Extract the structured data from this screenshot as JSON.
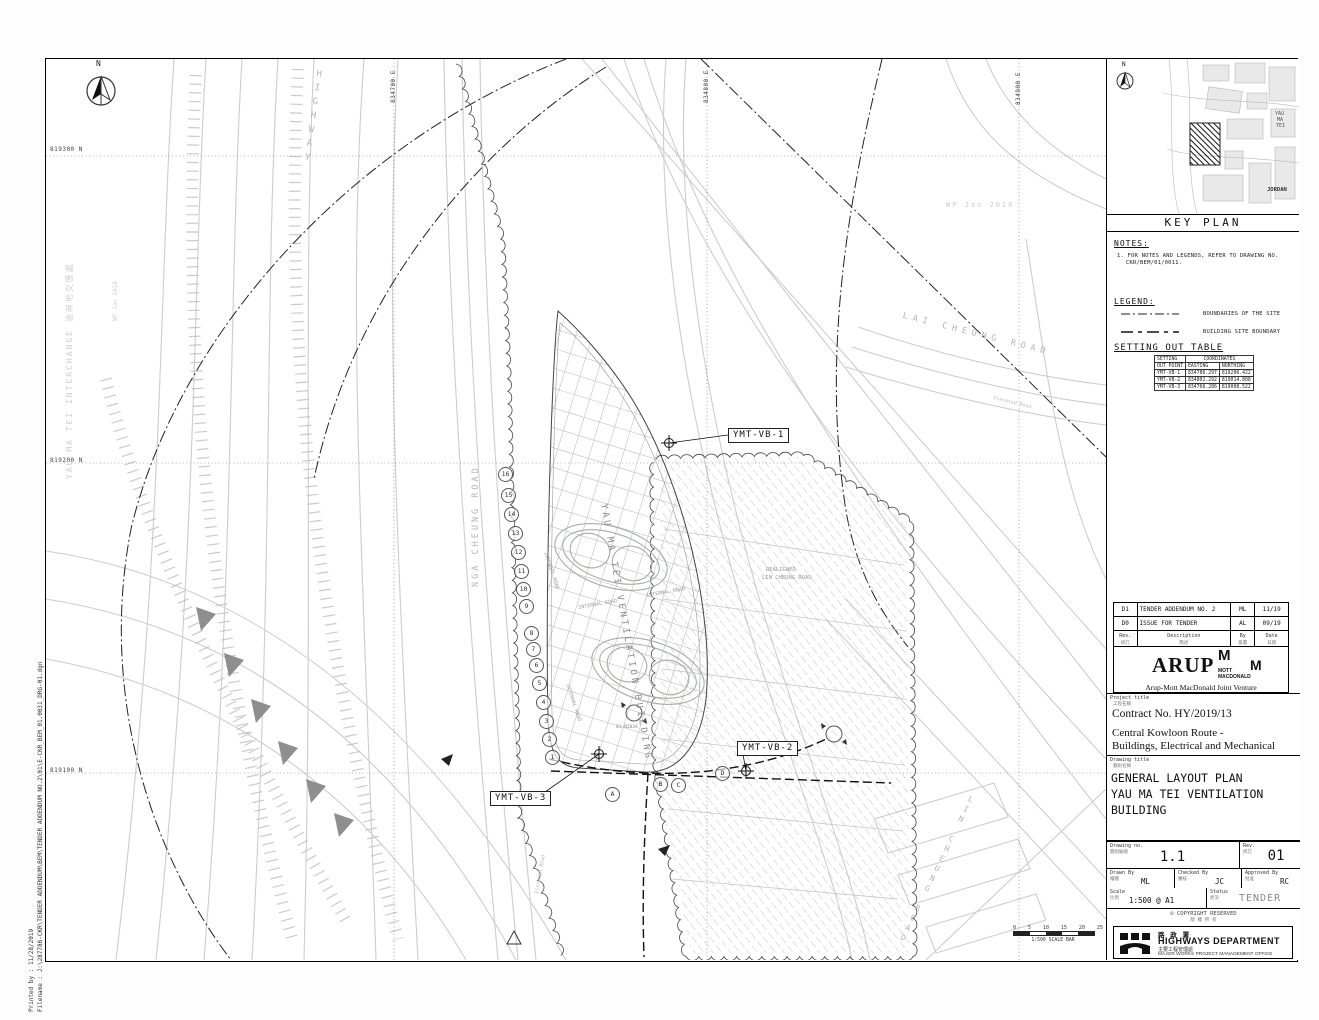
{
  "sheet": {
    "printed_by_line": "Printed by :  11/28/2019",
    "filename_line": "Filename :    J:\\287786-CKR\\TENDER ADDENDUM\\BEM\\TENDER ADDENDUM NO.2\\01\\E-CKR_BEM_01.0031_DRG-01.dgn"
  },
  "plan": {
    "north_label": "N",
    "grid_north": [
      "819300 N",
      "819200 N",
      "819100 N"
    ],
    "grid_east": [
      "834700 E",
      "834800 E",
      "834900 E"
    ],
    "labels": {
      "highway": "HIGHWAY",
      "interchange": "YAU MA TEI INTERCHANGE 油麻地交匯處",
      "nga_cheung_road": "NGA CHEUNG ROAD",
      "lai_cheung_road": "LAI CHEUNG ROAD",
      "lin_cheung_road": "LIN CHEUNG ROAD",
      "realigned_1": "REALIGNED",
      "realigned_2": "LIN CHEUNG ROAD",
      "internal_road": "INTERNAL ROAD",
      "elevated_road": "Elevated Road",
      "wp_note": "WP Jan 2018",
      "building": "YAU MA TEI VENTILATION BUILDING",
      "section_marker": "01-N2034"
    },
    "callouts": {
      "vb1": "YMT-VB-1",
      "vb2": "YMT-VB-2",
      "vb3": "YMT-VB-3"
    },
    "grid_bubbles_numbers": [
      "16",
      "15",
      "14",
      "13",
      "12",
      "11",
      "10",
      "9",
      "8",
      "7",
      "6",
      "5",
      "4",
      "3",
      "2",
      "1"
    ],
    "grid_bubbles_letters": [
      "A",
      "B",
      "C",
      "D"
    ],
    "scale_bar": {
      "ticks": [
        "0",
        "5",
        "10",
        "15",
        "20",
        "25 m"
      ],
      "label": "1:500 SCALE BAR"
    }
  },
  "key_plan": {
    "title": "KEY PLAN",
    "north_label": "N",
    "yau": "YAU",
    "ma": "MA",
    "tei": "TEI",
    "jordan": "JORDAN"
  },
  "notes": {
    "heading": "NOTES:",
    "item1_line1": "1.  FOR NOTES AND LEGENDS, REFER TO DRAWING NO.",
    "item1_line2": "CKR/BEM/01/0011."
  },
  "legend": {
    "heading": "LEGEND:",
    "item1": "BOUNDARIES OF THE SITE",
    "item2": "BUILDING SITE BOUNDARY"
  },
  "setting_out": {
    "heading": "SETTING OUT TABLE",
    "h_setting": "SETTING",
    "h_out_point": "OUT POINT",
    "h_coordinates": "COORDINATES",
    "h_easting": "EASTING",
    "h_northing": "NORTHING",
    "rows": [
      {
        "point": "YMT-VB-1",
        "easting": "834786.297",
        "northing": "819206.422"
      },
      {
        "point": "YMT-VB-2",
        "easting": "834802.292",
        "northing": "819014.808"
      },
      {
        "point": "YMT-VB-3",
        "easting": "834766.286",
        "northing": "819008.522"
      }
    ]
  },
  "revisions": {
    "rows": [
      {
        "rev": "D1",
        "description": "TENDER ADDENDUM NO. 2",
        "by": "ML",
        "date": "11/19"
      },
      {
        "rev": "D0",
        "description": "ISSUE FOR TENDER",
        "by": "AL",
        "date": "09/19"
      }
    ],
    "headers": {
      "rev": "Rev.",
      "rev_cn": "修訂",
      "description": "Description",
      "description_cn": "簡述",
      "by": "By",
      "by_cn": "簽署",
      "date": "Date",
      "date_cn": "日期"
    }
  },
  "firm": {
    "arup": "ARUP",
    "m1": "M",
    "m2": "M",
    "mott": "MOTT",
    "macdonald": "MACDONALD",
    "jv": "Arup-Mott MacDonald Joint Venture"
  },
  "title_block": {
    "project_title_label": "Project title",
    "project_title_cn": "工程名稱",
    "contract_no": "Contract No. HY/2019/13",
    "project_name_1": "Central Kowloon Route -",
    "project_name_2": "Buildings, Electrical and Mechanical",
    "drawing_title_label": "Drawing title",
    "drawing_title_cn": "圖則名稱",
    "drawing_title_1": "GENERAL LAYOUT PLAN",
    "drawing_title_2": "YAU MA TEI VENTILATION",
    "drawing_title_3": "BUILDING",
    "drawing_no_label": "Drawing no.",
    "drawing_no_cn": "圖則編號",
    "drawing_no": "1.1",
    "rev_label": "Rev.",
    "rev_cn": "修訂",
    "rev": "01",
    "drawn_label": "Drawn By",
    "drawn_cn": "繪圖",
    "drawn": "ML",
    "checked_label": "Checked By",
    "checked_cn": "審核",
    "checked": "JC",
    "approved_label": "Approved By",
    "approved_cn": "批准",
    "approved": "RC",
    "scale_label": "Scale",
    "scale_cn": "比例",
    "scale": "1:500 @ A1",
    "status_label": "Status",
    "status_cn": "狀況",
    "status": "TENDER",
    "copyright_symbol": "©",
    "copyright": "COPYRIGHT RESERVED",
    "copyright_cn": "版 權 所 有"
  },
  "department": {
    "name_cn": "路 政 署",
    "name": "HIGHWAYS DEPARTMENT",
    "office_cn": "主要工程管理處",
    "office": "MAJOR WORKS PROJECT MANAGEMENT OFFICE"
  }
}
